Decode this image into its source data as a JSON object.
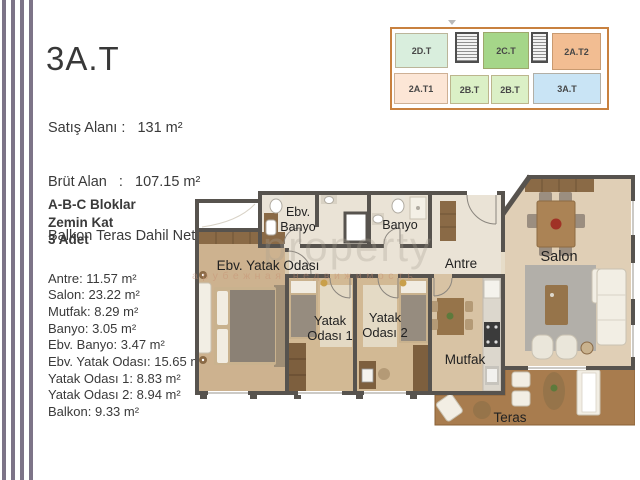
{
  "title": {
    "unit_code": "3A.T"
  },
  "header": {
    "lines": [
      "Satış Alanı :   131 m²",
      "Brüt Alan   :   107.15 m²",
      "Balkon Teras Dahil Net Alan: 92.35 m²"
    ]
  },
  "keyplan": {
    "outline_color": "#c8813f",
    "highlighted_unit": "3A.T",
    "units": [
      {
        "label": "2D.T",
        "color": "#d9eedd"
      },
      {
        "label": "2C.T",
        "color": "#a5d689"
      },
      {
        "label": "2A.T2",
        "color": "#f2bd92"
      },
      {
        "label": "2A.T1",
        "color": "#fce6d6"
      },
      {
        "label": "2B.T",
        "color": "#dbf0c6"
      },
      {
        "label": "2B.T",
        "color": "#dbf0c6"
      },
      {
        "label": "3A.T",
        "color": "#c9e4f5"
      }
    ]
  },
  "info": {
    "block_lines": [
      "A-B-C Bloklar",
      "Zemin Kat",
      "3 Adet"
    ],
    "areas": [
      "Antre: 11.57 m²",
      "Salon: 23.22 m²",
      "Mutfak: 8.29 m²",
      "Banyo: 3.05 m²",
      "Ebv. Banyo: 3.47 m²",
      "Ebv. Yatak Odası: 15.65 m²",
      "Yatak Odası 1: 8.83 m²",
      "Yatak Odası 2: 8.94 m²",
      "Balkon: 9.33 m²"
    ]
  },
  "floorplan": {
    "rooms": {
      "ebv_banyo_line1": "Ebv.",
      "ebv_banyo_line2": "Banyo",
      "banyo": "Banyo",
      "ebv_yatak_odasi": "Ebv. Yatak Odası",
      "antre": "Antre",
      "salon": "Salon",
      "yatak1_line1": "Yatak",
      "yatak1_line2": "Odası 1",
      "yatak2_line1": "Yatak",
      "yatak2_line2": "Odası 2",
      "mutfak": "Mutfak",
      "teras": "Teras"
    },
    "watermark": {
      "line1": "property",
      "line2": "зарубежная недвижимость"
    },
    "colors": {
      "wall": "#57534e",
      "tile": "#eae3d6",
      "wood": "#d2b994",
      "salon_floor": "#e0cfb6",
      "deck": "#a87c4e"
    }
  }
}
